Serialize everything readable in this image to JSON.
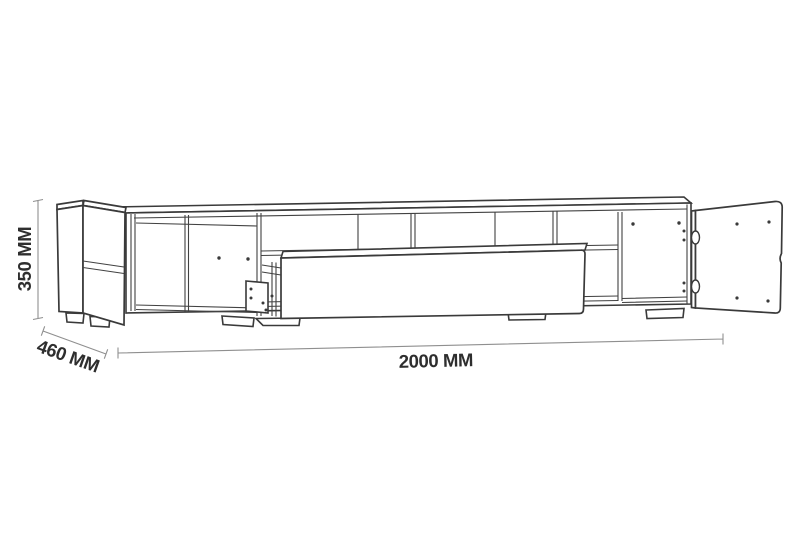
{
  "style": {
    "background_color": "#ffffff",
    "line_color": "#3a3a3a",
    "dimension_line_color": "#8f8f8f",
    "label_color": "#2e2e2e"
  },
  "drawing": {
    "description": "Technical line drawing of a TV stand with open left door, open right door and pulled-out drawer",
    "dimensions": {
      "height": {
        "label": "350 MM",
        "value": 350,
        "unit": "MM"
      },
      "depth": {
        "label": "460 MM",
        "value": 460,
        "unit": "MM"
      },
      "width": {
        "label": "2000 MM",
        "value": 2000,
        "unit": "MM"
      }
    }
  }
}
